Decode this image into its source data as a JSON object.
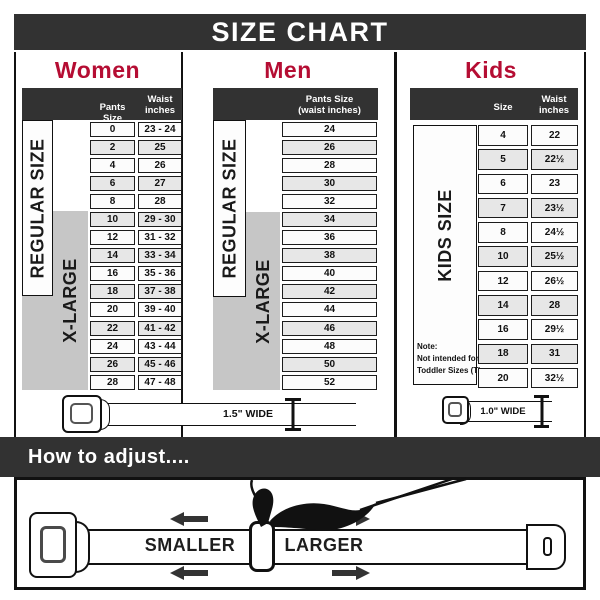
{
  "page": {
    "title": "SIZE CHART",
    "adjust_heading": "How to adjust....",
    "smaller": "SMALLER",
    "larger": "LARGER"
  },
  "women": {
    "heading": "Women",
    "header": {
      "col1": "Pants Size",
      "col2": "Waist\ninches"
    },
    "regular_label": "REGULAR SIZE",
    "xlarge_label": "X-LARGE",
    "rows": [
      [
        "0",
        "23 - 24"
      ],
      [
        "2",
        "25"
      ],
      [
        "4",
        "26"
      ],
      [
        "6",
        "27"
      ],
      [
        "8",
        "28"
      ],
      [
        "10",
        "29 - 30"
      ],
      [
        "12",
        "31 - 32"
      ],
      [
        "14",
        "33 - 34"
      ],
      [
        "16",
        "35 - 36"
      ],
      [
        "18",
        "37 - 38"
      ],
      [
        "20",
        "39 - 40"
      ],
      [
        "22",
        "41 - 42"
      ],
      [
        "24",
        "43 - 44"
      ],
      [
        "26",
        "45 - 46"
      ],
      [
        "28",
        "47 - 48"
      ]
    ],
    "belt_width_label": "1.5\" WIDE"
  },
  "men": {
    "heading": "Men",
    "header": {
      "col1": "Pants Size\n(waist inches)"
    },
    "regular_label": "REGULAR SIZE",
    "xlarge_label": "X-LARGE",
    "rows": [
      "24",
      "26",
      "28",
      "30",
      "32",
      "34",
      "36",
      "38",
      "40",
      "42",
      "44",
      "46",
      "48",
      "50",
      "52"
    ]
  },
  "kids": {
    "heading": "Kids",
    "header": {
      "col1": "Size",
      "col2": "Waist\ninches"
    },
    "side_label": "KIDS SIZE",
    "note": "Note:\nNot intended for\nToddler Sizes (T)",
    "rows": [
      [
        "4",
        "22"
      ],
      [
        "5",
        "22½"
      ],
      [
        "6",
        "23"
      ],
      [
        "7",
        "23½"
      ],
      [
        "8",
        "24½"
      ],
      [
        "10",
        "25½"
      ],
      [
        "12",
        "26½"
      ],
      [
        "14",
        "28"
      ],
      [
        "16",
        "29½"
      ],
      [
        "18",
        "31"
      ],
      [
        "20",
        "32½"
      ]
    ],
    "belt_width_label": "1.0\" WIDE"
  },
  "colors": {
    "accent_red": "#b50d33",
    "bar_dark": "#323232",
    "block_gray": "#c6c6c6",
    "row_alt": "#e7e7e7"
  }
}
